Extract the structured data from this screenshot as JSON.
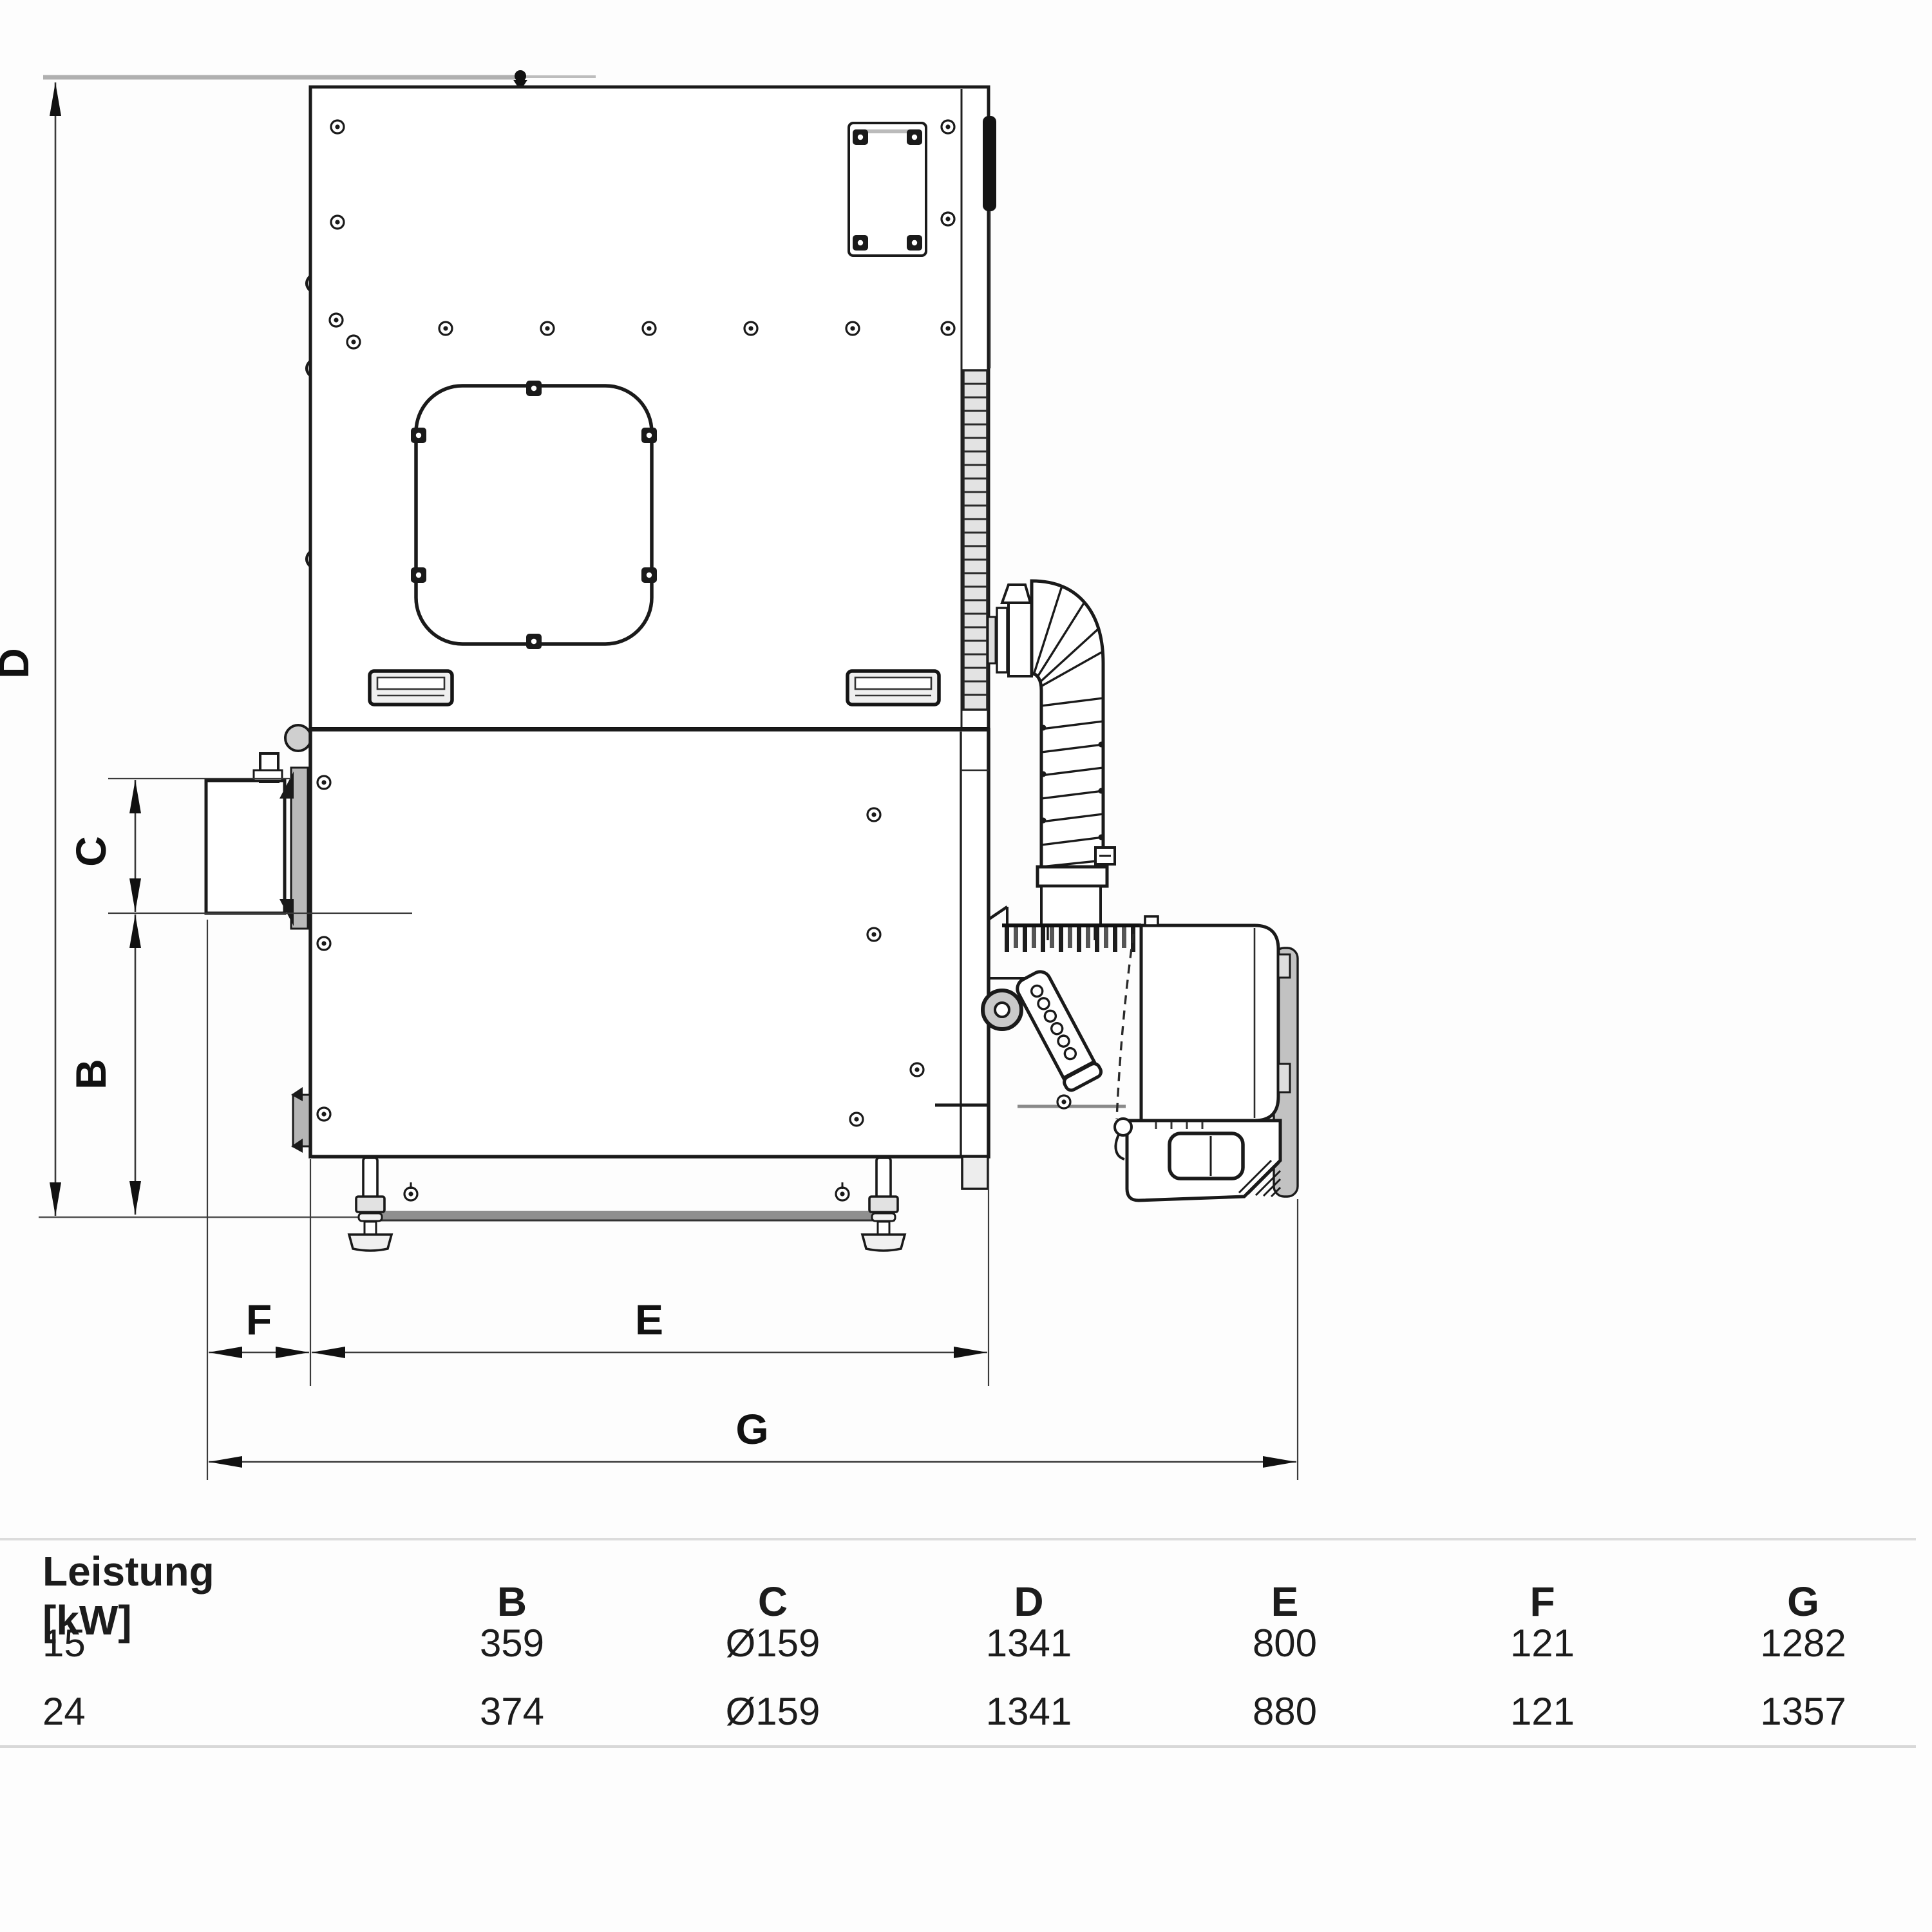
{
  "diagram": {
    "dimension_labels": {
      "b": "B",
      "c": "C",
      "d": "D",
      "e": "E",
      "f": "F",
      "g": "G"
    },
    "colors": {
      "line": "#1a1a1a",
      "dim": "#3a3a3a",
      "ref_gray": "#b0b0b0",
      "fill_gray": "#c9c9c9"
    }
  },
  "table": {
    "header_col1_line1": "Leistung",
    "header_col1_line2": "[kW]",
    "columns": [
      "B",
      "C",
      "D",
      "E",
      "F",
      "G"
    ],
    "rows": [
      {
        "power": "15",
        "values": [
          "359",
          "Ø159",
          "1341",
          "800",
          "121",
          "1282"
        ]
      },
      {
        "power": "24",
        "values": [
          "374",
          "Ø159",
          "1341",
          "880",
          "121",
          "1357"
        ]
      }
    ]
  }
}
